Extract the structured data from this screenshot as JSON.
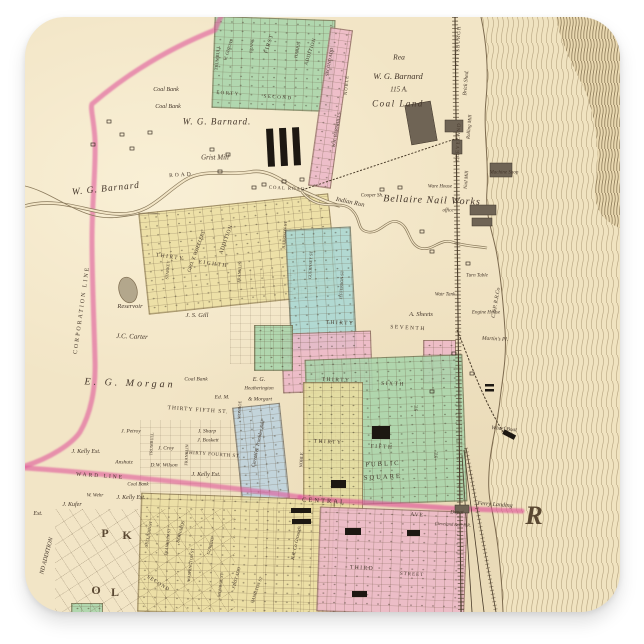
{
  "product": {
    "kind": "square sticker",
    "subject": "Vintage plat map of Bellaire, Ohio on the Ohio River",
    "background_color": "#ffffff"
  },
  "palette": {
    "paper": "#f2e5c6",
    "green": "#a8d5ab",
    "teal": "#a9d8d4",
    "yellow": "#ecdfa2",
    "pink": "#edb9c9",
    "blue": "#bdd3df",
    "boundary_pink": "#e0559a",
    "ink": "#44362a",
    "river_hatch": "#a5916c"
  },
  "map": {
    "labels": [
      {
        "t": "W. G. Barnard.",
        "x": 217,
        "y": 122,
        "s": 9,
        "i": 1,
        "ls": 1
      },
      {
        "t": "Coal Bank",
        "x": 166,
        "y": 90,
        "s": 6,
        "i": 1
      },
      {
        "t": "Coal Bank",
        "x": 168,
        "y": 107,
        "s": 6,
        "i": 1
      },
      {
        "t": "Grist Mill",
        "x": 215,
        "y": 158,
        "s": 7,
        "i": 1
      },
      {
        "t": "ROAD",
        "x": 181,
        "y": 176,
        "s": 5.5,
        "r": -4,
        "ls": 2
      },
      {
        "t": "COAL ROAD",
        "x": 287,
        "y": 190,
        "s": 4.8,
        "r": 3,
        "ls": 1
      },
      {
        "t": "W. G. Barnard",
        "x": 106,
        "y": 190,
        "s": 9.5,
        "i": 1,
        "r": -6,
        "ls": 1
      },
      {
        "t": "Rea",
        "x": 399,
        "y": 57,
        "s": 7.5,
        "i": 1
      },
      {
        "t": "W. G. Barnard",
        "x": 398,
        "y": 76,
        "s": 8.5,
        "i": 1
      },
      {
        "t": "115 A.",
        "x": 399,
        "y": 90,
        "s": 7,
        "i": 1
      },
      {
        "t": "Coal Land",
        "x": 398,
        "y": 104,
        "s": 9,
        "i": 1,
        "ls": 1.5
      },
      {
        "t": "PITTSBURGH",
        "x": 459,
        "y": 46,
        "s": 5,
        "r": -87,
        "ls": 1
      },
      {
        "t": "CLEVELAND",
        "x": 459,
        "y": 142,
        "s": 5,
        "r": -87,
        "ls": 1
      },
      {
        "t": "Brick Shed.",
        "x": 467,
        "y": 83,
        "s": 5.5,
        "i": 1,
        "r": -85
      },
      {
        "t": "Machine Shop",
        "x": 504,
        "y": 173,
        "s": 5,
        "i": 1
      },
      {
        "t": "Ware House",
        "x": 440,
        "y": 187,
        "s": 5,
        "i": 1
      },
      {
        "t": "Bellaire Nail Works",
        "x": 432,
        "y": 201,
        "s": 10,
        "i": 1,
        "ls": 1,
        "r": 2
      },
      {
        "t": "office",
        "x": 448,
        "y": 211,
        "s": 5,
        "i": 1
      },
      {
        "t": "Cooper Sh.",
        "x": 372,
        "y": 196,
        "s": 5,
        "i": 1
      },
      {
        "t": "Indian Run",
        "x": 350,
        "y": 203,
        "s": 6.5,
        "i": 1,
        "r": 12
      },
      {
        "t": "Rolling Mill",
        "x": 470,
        "y": 127,
        "s": 5,
        "i": 1,
        "r": -85
      },
      {
        "t": "Nail Mill",
        "x": 467,
        "y": 180,
        "s": 5,
        "i": 1,
        "r": -85
      },
      {
        "t": "FORTY",
        "x": 228,
        "y": 94,
        "s": 5,
        "r": 4,
        "ls": 1.5
      },
      {
        "t": "SECOND",
        "x": 278,
        "y": 98,
        "s": 5,
        "r": 4,
        "ls": 1.5
      },
      {
        "t": "TRUMBULL",
        "x": 218,
        "y": 58,
        "s": 4.5,
        "r": -85
      },
      {
        "t": "W. GHIONS",
        "x": 229,
        "y": 50,
        "s": 4.5,
        "r": -72,
        "i": 1
      },
      {
        "t": "FIRST",
        "x": 270,
        "y": 44,
        "s": 5.5,
        "r": -72,
        "ls": 1
      },
      {
        "t": "FRANK",
        "x": 252,
        "y": 46,
        "s": 4.2,
        "r": -85
      },
      {
        "t": "HARRIS",
        "x": 298,
        "y": 50,
        "s": 4.5,
        "r": -78
      },
      {
        "t": "ADDITION",
        "x": 311,
        "y": 52,
        "s": 5,
        "r": -72,
        "ls": 0.5
      },
      {
        "t": "SECOND ADD",
        "x": 330,
        "y": 62,
        "s": 4.5,
        "r": -80
      },
      {
        "t": "W.H. BARNHILLS",
        "x": 337,
        "y": 130,
        "s": 4.5,
        "r": -80
      },
      {
        "t": "NOBLE",
        "x": 347,
        "y": 85,
        "s": 4.5,
        "r": -85,
        "ls": 1
      },
      {
        "t": "CORPORATION LINE",
        "x": 82,
        "y": 310,
        "s": 6,
        "r": -82,
        "ls": 2
      },
      {
        "t": "Reservoir",
        "x": 130,
        "y": 307,
        "s": 6.5,
        "i": 1
      },
      {
        "t": "J. S. Gill",
        "x": 197,
        "y": 316,
        "s": 6.5,
        "i": 1
      },
      {
        "t": "J.C. Carter",
        "x": 132,
        "y": 337,
        "s": 7,
        "i": 1,
        "r": 2
      },
      {
        "t": "E. G. Morgan",
        "x": 130,
        "y": 384,
        "s": 10,
        "i": 1,
        "ls": 3,
        "r": 2
      },
      {
        "t": "Coal Bank",
        "x": 196,
        "y": 380,
        "s": 5.5,
        "i": 1
      },
      {
        "t": "Ed. M.",
        "x": 222,
        "y": 398,
        "s": 5.5,
        "i": 1
      },
      {
        "t": "E. G.",
        "x": 259,
        "y": 380,
        "s": 6,
        "i": 1
      },
      {
        "t": "Heatherington",
        "x": 259,
        "y": 389,
        "s": 5,
        "i": 1
      },
      {
        "t": "& Morgart",
        "x": 260,
        "y": 400,
        "s": 5.5,
        "i": 1
      },
      {
        "t": "THIRTY",
        "x": 170,
        "y": 258,
        "s": 5.5,
        "r": 8,
        "ls": 1.5
      },
      {
        "t": "EIGHTH",
        "x": 213,
        "y": 265,
        "s": 5.5,
        "r": 8,
        "ls": 1.5
      },
      {
        "t": "GEO. T. WHEELERS",
        "x": 197,
        "y": 252,
        "s": 5,
        "r": -70,
        "i": 1
      },
      {
        "t": "ADDITION",
        "x": 227,
        "y": 240,
        "s": 5.5,
        "r": -70,
        "ls": 0.5
      },
      {
        "t": "STARKEY",
        "x": 168,
        "y": 270,
        "s": 4.2,
        "r": -85
      },
      {
        "t": "FRANKLIN",
        "x": 240,
        "y": 272,
        "s": 4.2,
        "r": -85
      },
      {
        "t": "HARRISON ST",
        "x": 285,
        "y": 235,
        "s": 4.2,
        "r": -85
      },
      {
        "t": "GUERNSEY ST",
        "x": 311,
        "y": 265,
        "s": 4.2,
        "r": -87
      },
      {
        "t": "JEFFERSON ST",
        "x": 342,
        "y": 285,
        "s": 4.2,
        "r": -87
      },
      {
        "t": "THIRTY",
        "x": 340,
        "y": 324,
        "s": 5.5,
        "r": 2,
        "ls": 1.5
      },
      {
        "t": "SEVENTH",
        "x": 408,
        "y": 329,
        "s": 5.5,
        "r": 3,
        "ls": 1.5
      },
      {
        "t": "A. Sheets",
        "x": 421,
        "y": 315,
        "s": 6.5,
        "i": 1
      },
      {
        "t": "Turn Table",
        "x": 477,
        "y": 276,
        "s": 5,
        "i": 1
      },
      {
        "t": "Watr Tank",
        "x": 445,
        "y": 295,
        "s": 5,
        "i": 1
      },
      {
        "t": "Engine House",
        "x": 486,
        "y": 313,
        "s": 5,
        "i": 1
      },
      {
        "t": "C.&P. R.R.Co",
        "x": 497,
        "y": 303,
        "s": 5.5,
        "i": 1,
        "r": -80
      },
      {
        "t": "Martin's Pl.",
        "x": 495,
        "y": 340,
        "s": 5.5,
        "i": 1,
        "r": 3
      },
      {
        "t": "THIRTY",
        "x": 336,
        "y": 381,
        "s": 5.5,
        "r": 2,
        "ls": 1.5
      },
      {
        "t": "SIXTH",
        "x": 393,
        "y": 385,
        "s": 5.5,
        "r": 2,
        "ls": 1.5
      },
      {
        "t": "ST.",
        "x": 417,
        "y": 408,
        "s": 5,
        "r": -87
      },
      {
        "t": "THIRTY",
        "x": 328,
        "y": 443,
        "s": 5.5,
        "r": 3,
        "ls": 1.5
      },
      {
        "t": "FIFTH",
        "x": 382,
        "y": 448,
        "s": 5.5,
        "r": 3,
        "ls": 1.5
      },
      {
        "t": "ST.",
        "x": 437,
        "y": 455,
        "s": 5,
        "r": -85
      },
      {
        "t": "PUBLIC",
        "x": 383,
        "y": 465,
        "s": 6.5,
        "ls": 2,
        "r": -3
      },
      {
        "t": "SQUARE",
        "x": 383,
        "y": 478,
        "s": 6.5,
        "ls": 2,
        "r": -3
      },
      {
        "t": "NOBLE",
        "x": 302,
        "y": 460,
        "s": 4.5,
        "r": -87
      },
      {
        "t": "THIRTY FIFTH ST.",
        "x": 198,
        "y": 411,
        "s": 5.5,
        "r": 4,
        "ls": 1
      },
      {
        "t": "THIRTY FOURTH ST.",
        "x": 213,
        "y": 455,
        "s": 5,
        "r": 4,
        "ls": 0.5
      },
      {
        "t": "MONROE",
        "x": 240,
        "y": 410,
        "s": 4.2,
        "r": -87
      },
      {
        "t": "FRANKLIN",
        "x": 187,
        "y": 455,
        "s": 4.2,
        "r": -87
      },
      {
        "t": "TRUMBULL",
        "x": 152,
        "y": 444,
        "s": 4.2,
        "r": -87
      },
      {
        "t": "J. Petroy",
        "x": 131,
        "y": 432,
        "s": 5.5,
        "i": 1
      },
      {
        "t": "J. Sharp",
        "x": 207,
        "y": 432,
        "s": 5.5,
        "i": 1
      },
      {
        "t": "J. Boskett",
        "x": 208,
        "y": 441,
        "s": 5.5,
        "i": 1
      },
      {
        "t": "J. Croy",
        "x": 166,
        "y": 449,
        "s": 5.5,
        "i": 1
      },
      {
        "t": "D.W. Wilson",
        "x": 164,
        "y": 466,
        "s": 5.5,
        "i": 1
      },
      {
        "t": "Anshutz",
        "x": 124,
        "y": 463,
        "s": 5.5,
        "i": 1
      },
      {
        "t": "J. Kelly Est.",
        "x": 86,
        "y": 452,
        "s": 6,
        "i": 1
      },
      {
        "t": "J. Kelly Est.",
        "x": 206,
        "y": 475,
        "s": 6,
        "i": 1
      },
      {
        "t": "J. Kelly Est.",
        "x": 131,
        "y": 498,
        "s": 6,
        "i": 1
      },
      {
        "t": "Coal Bank",
        "x": 138,
        "y": 485,
        "s": 5,
        "i": 1
      },
      {
        "t": "Carroll & Trimbles Add",
        "x": 259,
        "y": 444,
        "s": 5,
        "i": 1,
        "r": -78
      },
      {
        "t": "WARD LINE",
        "x": 100,
        "y": 477,
        "s": 5.5,
        "r": 4,
        "ls": 2
      },
      {
        "t": "J. Kufer",
        "x": 72,
        "y": 505,
        "s": 6,
        "i": 1
      },
      {
        "t": "W. Wehr",
        "x": 95,
        "y": 496,
        "s": 5,
        "i": 1
      },
      {
        "t": "Est.",
        "x": 38,
        "y": 514,
        "s": 6,
        "i": 1
      },
      {
        "t": "ND ADDITION",
        "x": 47,
        "y": 556,
        "s": 6,
        "i": 1,
        "r": -75
      },
      {
        "t": "P",
        "x": 105,
        "y": 533,
        "s": 12,
        "b": 1
      },
      {
        "t": "K",
        "x": 127,
        "y": 535,
        "s": 12,
        "b": 1
      },
      {
        "t": "O",
        "x": 96,
        "y": 590,
        "s": 12,
        "b": 1
      },
      {
        "t": "L",
        "x": 115,
        "y": 592,
        "s": 12,
        "b": 1
      },
      {
        "t": "SECOND",
        "x": 158,
        "y": 584,
        "s": 5,
        "r": 32,
        "ls": 1
      },
      {
        "t": "SULLIVAN ST",
        "x": 149,
        "y": 534,
        "s": 4.2,
        "r": -80
      },
      {
        "t": "FRANKLIN ST",
        "x": 168,
        "y": 542,
        "s": 4.2,
        "r": -83
      },
      {
        "t": "BERNARDS",
        "x": 181,
        "y": 532,
        "s": 4.5,
        "r": -75,
        "i": 1
      },
      {
        "t": "WASHINGTON ST",
        "x": 191,
        "y": 565,
        "s": 4.2,
        "r": -83
      },
      {
        "t": "COWANS",
        "x": 211,
        "y": 546,
        "s": 4.5,
        "r": -75,
        "i": 1
      },
      {
        "t": "MONROE ST",
        "x": 221,
        "y": 585,
        "s": 4.2,
        "r": -83
      },
      {
        "t": "FIRST ADD",
        "x": 237,
        "y": 578,
        "s": 4.5,
        "r": -75,
        "i": 1
      },
      {
        "t": "HAMILTON ST",
        "x": 257,
        "y": 590,
        "s": 4.2,
        "r": -70
      },
      {
        "t": "R.R. Co Grounds",
        "x": 297,
        "y": 543,
        "s": 5,
        "i": 1,
        "r": -78
      },
      {
        "t": "CENTRAL",
        "x": 324,
        "y": 502,
        "s": 6.5,
        "r": 3,
        "ls": 2
      },
      {
        "t": "AVE",
        "x": 417,
        "y": 516,
        "s": 5.5,
        "r": 4,
        "ls": 1
      },
      {
        "t": "Ferry Landing",
        "x": 495,
        "y": 505,
        "s": 6,
        "i": 1,
        "r": 4
      },
      {
        "t": "Depot",
        "x": 457,
        "y": 513,
        "s": 5.5,
        "i": 1
      },
      {
        "t": "Cleveland & P. R.R.",
        "x": 453,
        "y": 525,
        "s": 4.5,
        "i": 1,
        "r": 3
      },
      {
        "t": "THIRD",
        "x": 362,
        "y": 569,
        "s": 5.5,
        "r": 3,
        "ls": 1.5
      },
      {
        "t": "STREET",
        "x": 412,
        "y": 575,
        "s": 5,
        "r": 3,
        "ls": 1
      },
      {
        "t": "Wharf Boat",
        "x": 504,
        "y": 430,
        "s": 5.5,
        "i": 1,
        "r": 5
      },
      {
        "t": "R",
        "x": 534,
        "y": 516,
        "s": 26,
        "b": 1,
        "i": 1
      }
    ]
  }
}
